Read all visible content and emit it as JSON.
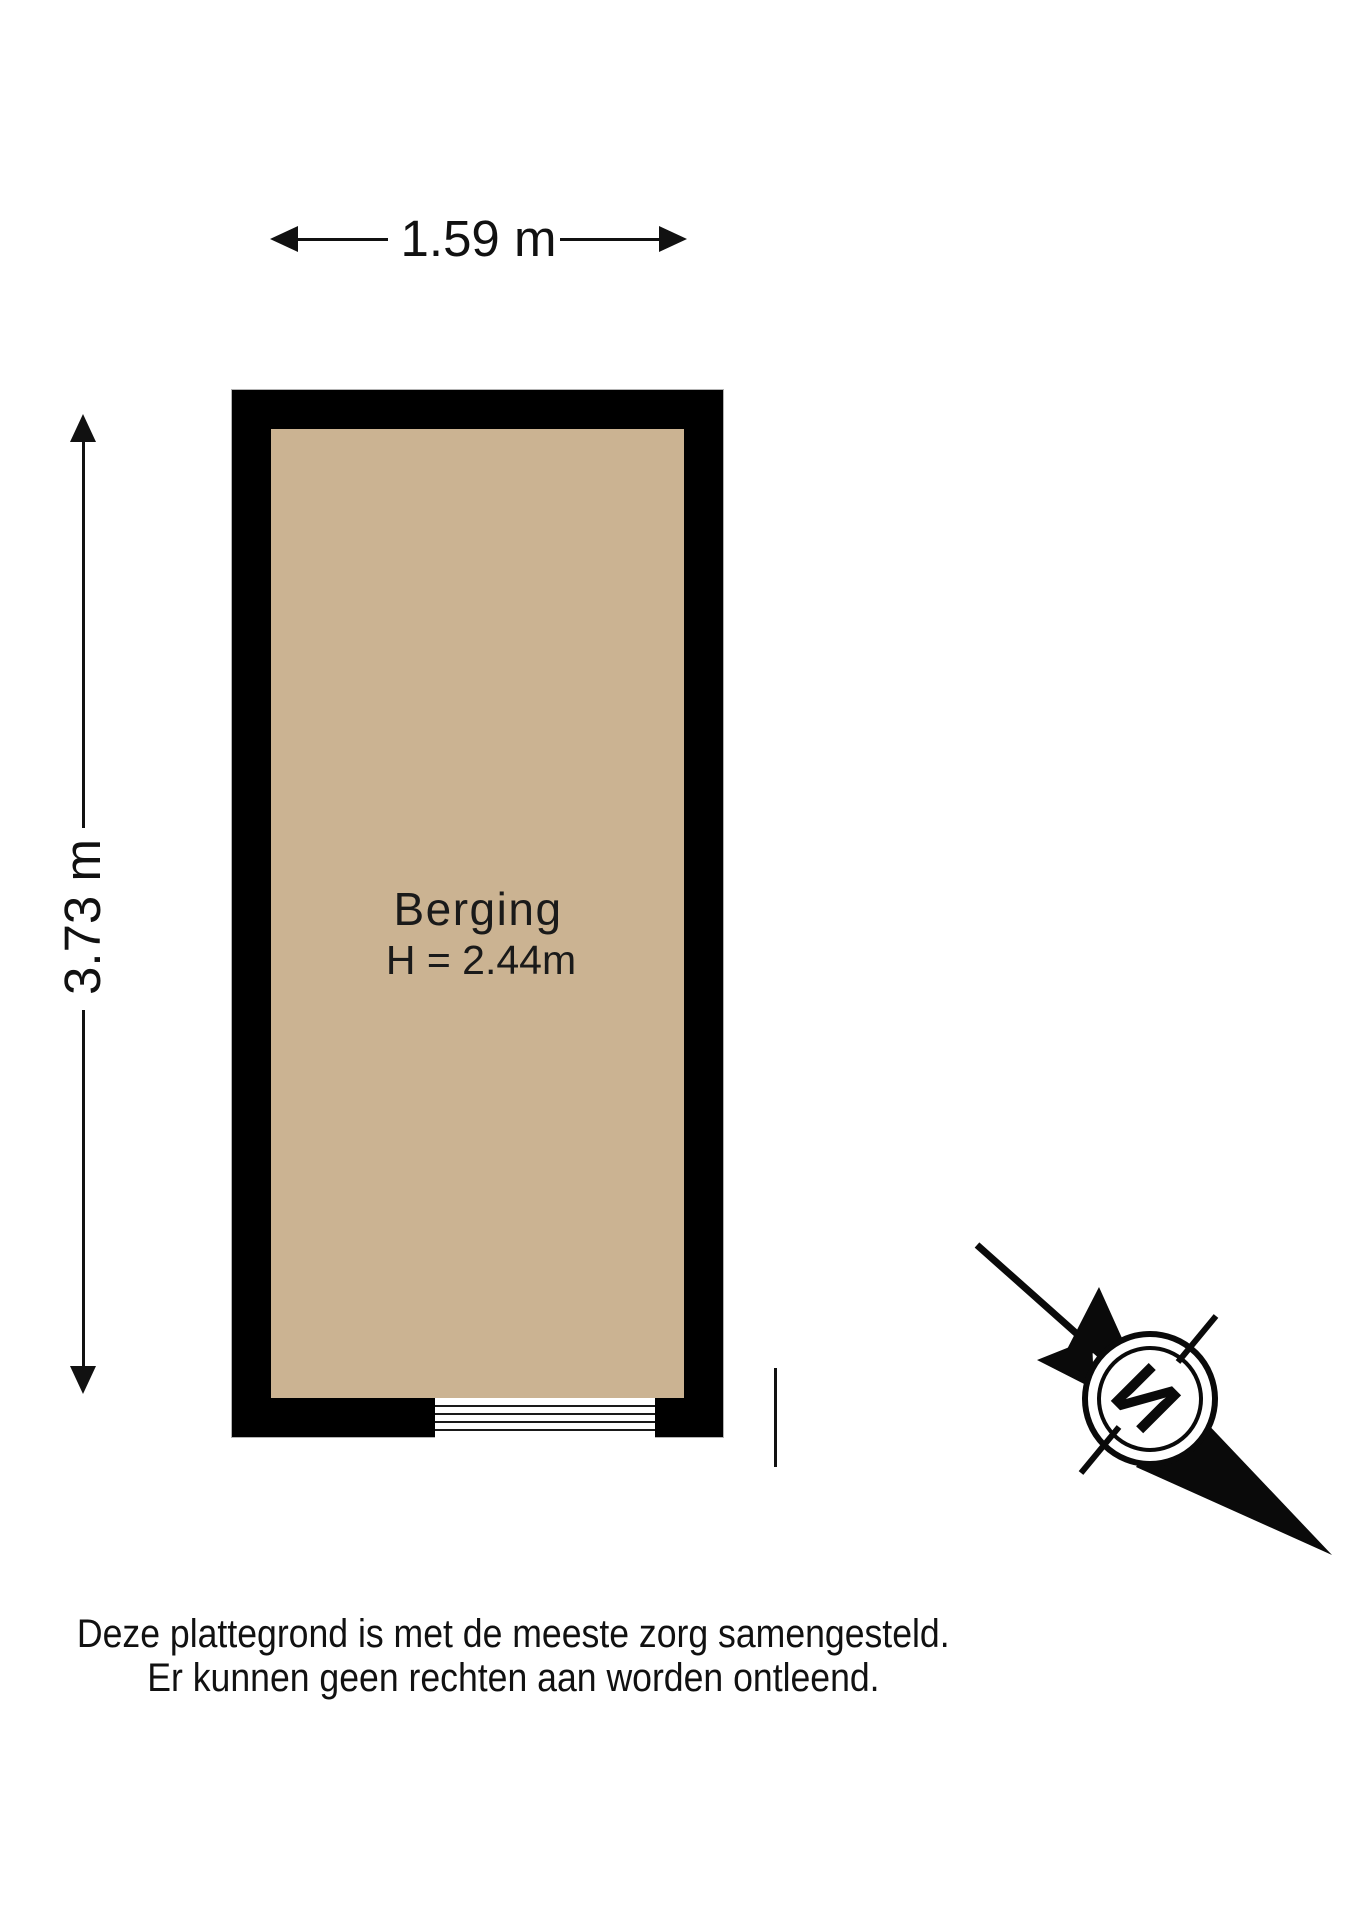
{
  "page": {
    "background": "#ffffff"
  },
  "dimensions": {
    "width": {
      "label": "1.59 m"
    },
    "height": {
      "label": "3.73 m"
    }
  },
  "room": {
    "name": "Berging",
    "ceiling_height": "H = 2.44m",
    "floor_color": "#cbb392",
    "wall_color": "#000000"
  },
  "compass": {
    "north_letter": "N"
  },
  "disclaimer": {
    "line1": "Deze plattegrond is met de meeste zorg samengesteld.",
    "line2": "Er kunnen geen rechten aan worden ontleend."
  }
}
